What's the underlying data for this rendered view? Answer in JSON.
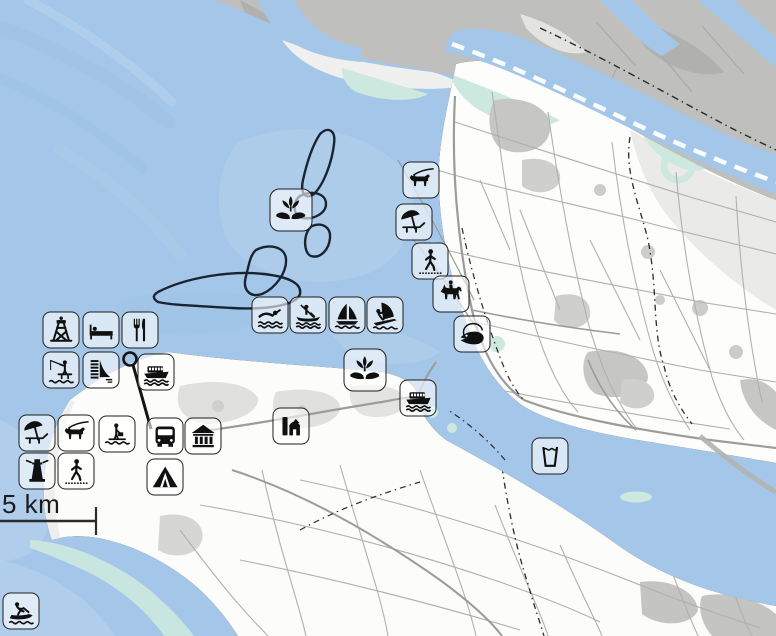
{
  "map": {
    "kind": "coastal recreation map",
    "scale_bar": {
      "label": "5 km"
    },
    "colors": {
      "water": "#a4c6e8",
      "water_light": "#b9d4ee",
      "shallow_mint": "#cde8df",
      "land": "#fdfdfc",
      "industrial": "#bfbfbd",
      "forest_urban": "#c6c6c4",
      "road": "#9c9c9a",
      "field_line": "#b0b0ae",
      "icon_ink": "#101010",
      "badge_bg": "rgba(255,255,255,0.60)",
      "outline_ink": "#1a2430"
    },
    "icons": [
      {
        "id": "nature-reserve-north",
        "title": "nature reserve",
        "symbol": "plant-hands",
        "x": 291,
        "y": 210,
        "large": true
      },
      {
        "id": "dog-walking-north",
        "title": "dog walking area",
        "symbol": "dog",
        "x": 421,
        "y": 180
      },
      {
        "id": "beach-north",
        "title": "beach with lounger",
        "symbol": "beach",
        "x": 414,
        "y": 222
      },
      {
        "id": "walking-route-north",
        "title": "walking route",
        "symbol": "walking",
        "x": 430,
        "y": 261
      },
      {
        "id": "horse-riding",
        "title": "horse riding",
        "symbol": "horse",
        "x": 451,
        "y": 294
      },
      {
        "id": "fishing-spot",
        "title": "fishing water",
        "symbol": "fish",
        "x": 472,
        "y": 334
      },
      {
        "id": "swimming",
        "title": "swimming",
        "symbol": "swimming",
        "x": 270,
        "y": 315
      },
      {
        "id": "canoeing",
        "title": "canoeing",
        "symbol": "canoe",
        "x": 308,
        "y": 315
      },
      {
        "id": "sailing",
        "title": "sailing",
        "symbol": "sailboat",
        "x": 347,
        "y": 315
      },
      {
        "id": "windsurfing",
        "title": "windsurfing",
        "symbol": "windsurf",
        "x": 385,
        "y": 315
      },
      {
        "id": "observation-tower",
        "title": "observation tower",
        "symbol": "tower",
        "x": 61,
        "y": 330
      },
      {
        "id": "accommodation",
        "title": "accommodation",
        "symbol": "bed",
        "x": 101,
        "y": 330
      },
      {
        "id": "restaurant",
        "title": "restaurant",
        "symbol": "cutlery",
        "x": 140,
        "y": 330
      },
      {
        "id": "fishing-jetty",
        "title": "fishing jetty",
        "symbol": "angler",
        "x": 61,
        "y": 370
      },
      {
        "id": "dam-sluice",
        "title": "dam / sluice",
        "symbol": "dam",
        "x": 101,
        "y": 370
      },
      {
        "id": "ferry-west",
        "title": "ferry",
        "symbol": "ferry",
        "x": 156,
        "y": 372
      },
      {
        "id": "nature-reserve-south",
        "title": "nature reserve",
        "symbol": "plant-hands",
        "x": 365,
        "y": 370,
        "large": true
      },
      {
        "id": "ferry-east",
        "title": "ferry",
        "symbol": "ferry",
        "x": 418,
        "y": 398
      },
      {
        "id": "fort-monument",
        "title": "fort / monument",
        "symbol": "fort",
        "x": 291,
        "y": 426
      },
      {
        "id": "beach-south",
        "title": "beach with lounger",
        "symbol": "beach",
        "x": 37,
        "y": 433
      },
      {
        "id": "dog-walking-south",
        "title": "dog walking area",
        "symbol": "dog",
        "x": 76,
        "y": 433
      },
      {
        "id": "landing-stage",
        "title": "bathing / landing stage",
        "symbol": "passenger",
        "x": 117,
        "y": 434
      },
      {
        "id": "bus-stop",
        "title": "bus",
        "symbol": "bus",
        "x": 165,
        "y": 436
      },
      {
        "id": "museum",
        "title": "museum",
        "symbol": "museum",
        "x": 203,
        "y": 436
      },
      {
        "id": "lighthouse",
        "title": "lighthouse",
        "symbol": "lighthouse",
        "x": 37,
        "y": 471
      },
      {
        "id": "walking-route-south",
        "title": "walking route",
        "symbol": "walking",
        "x": 76,
        "y": 471
      },
      {
        "id": "camping",
        "title": "camping",
        "symbol": "tent",
        "x": 165,
        "y": 477
      },
      {
        "id": "drinking-water",
        "title": "drinking water",
        "symbol": "water-glass",
        "x": 550,
        "y": 456
      },
      {
        "id": "jet-skiing",
        "title": "jet skiing",
        "symbol": "jetski",
        "x": 21,
        "y": 611
      }
    ]
  }
}
